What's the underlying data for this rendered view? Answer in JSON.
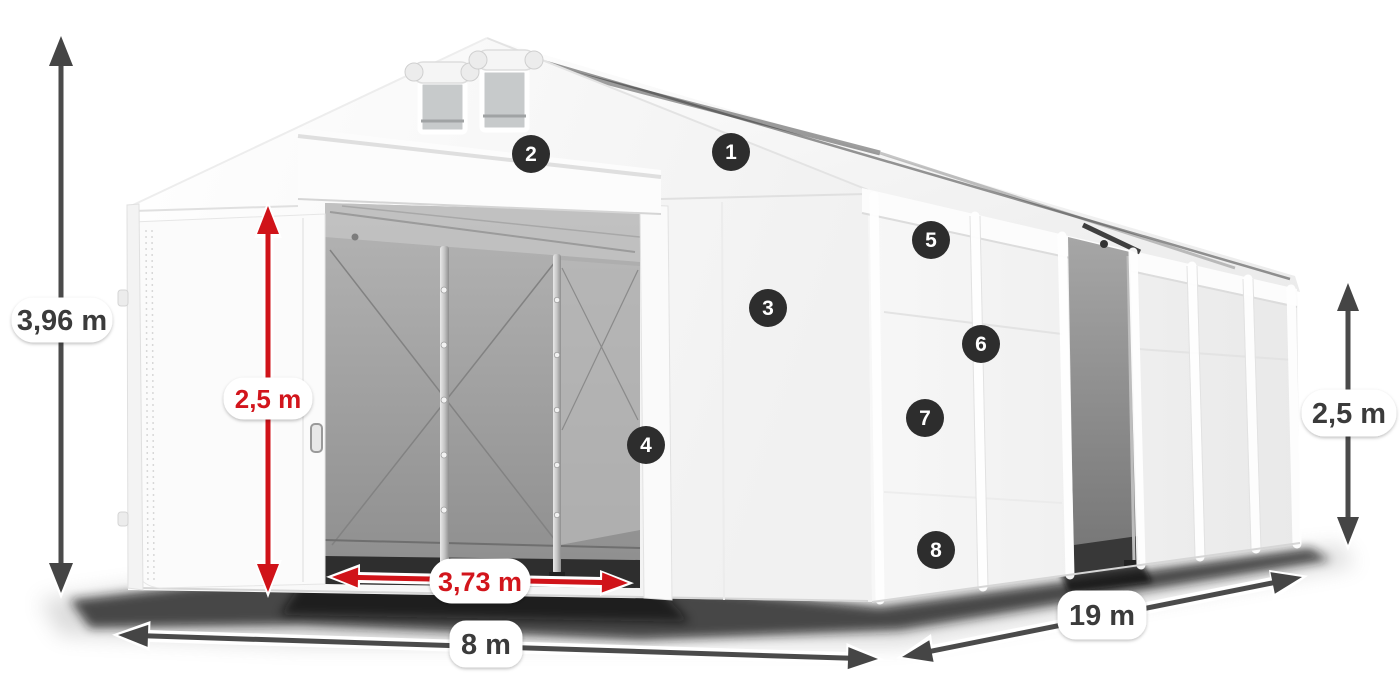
{
  "diagram": {
    "background": "#ffffff",
    "subject": "warehouse-tent-dimension-diagram",
    "dimension_labels": {
      "total_height": "3,96 m",
      "entrance_height": "2,5 m",
      "entrance_width": "3,73 m",
      "front_width": "8 m",
      "length": "19 m",
      "side_wall_height": "2,5 m"
    },
    "feature_markers": [
      {
        "number": "1"
      },
      {
        "number": "2"
      },
      {
        "number": "3"
      },
      {
        "number": "4"
      },
      {
        "number": "5"
      },
      {
        "number": "6"
      },
      {
        "number": "7"
      },
      {
        "number": "8"
      }
    ],
    "colors": {
      "dimension_arrow_dark": "#4a4a4a",
      "dimension_arrow_red": "#d01319",
      "label_text_dark": "#3b3b3b",
      "label_text_red": "#d2151c",
      "label_background": "#ffffff",
      "marker_background": "#2d2d2d",
      "marker_text": "#ffffff",
      "tent_white": "#f7f7f7",
      "interior_gray": "#9c9c9c"
    }
  }
}
